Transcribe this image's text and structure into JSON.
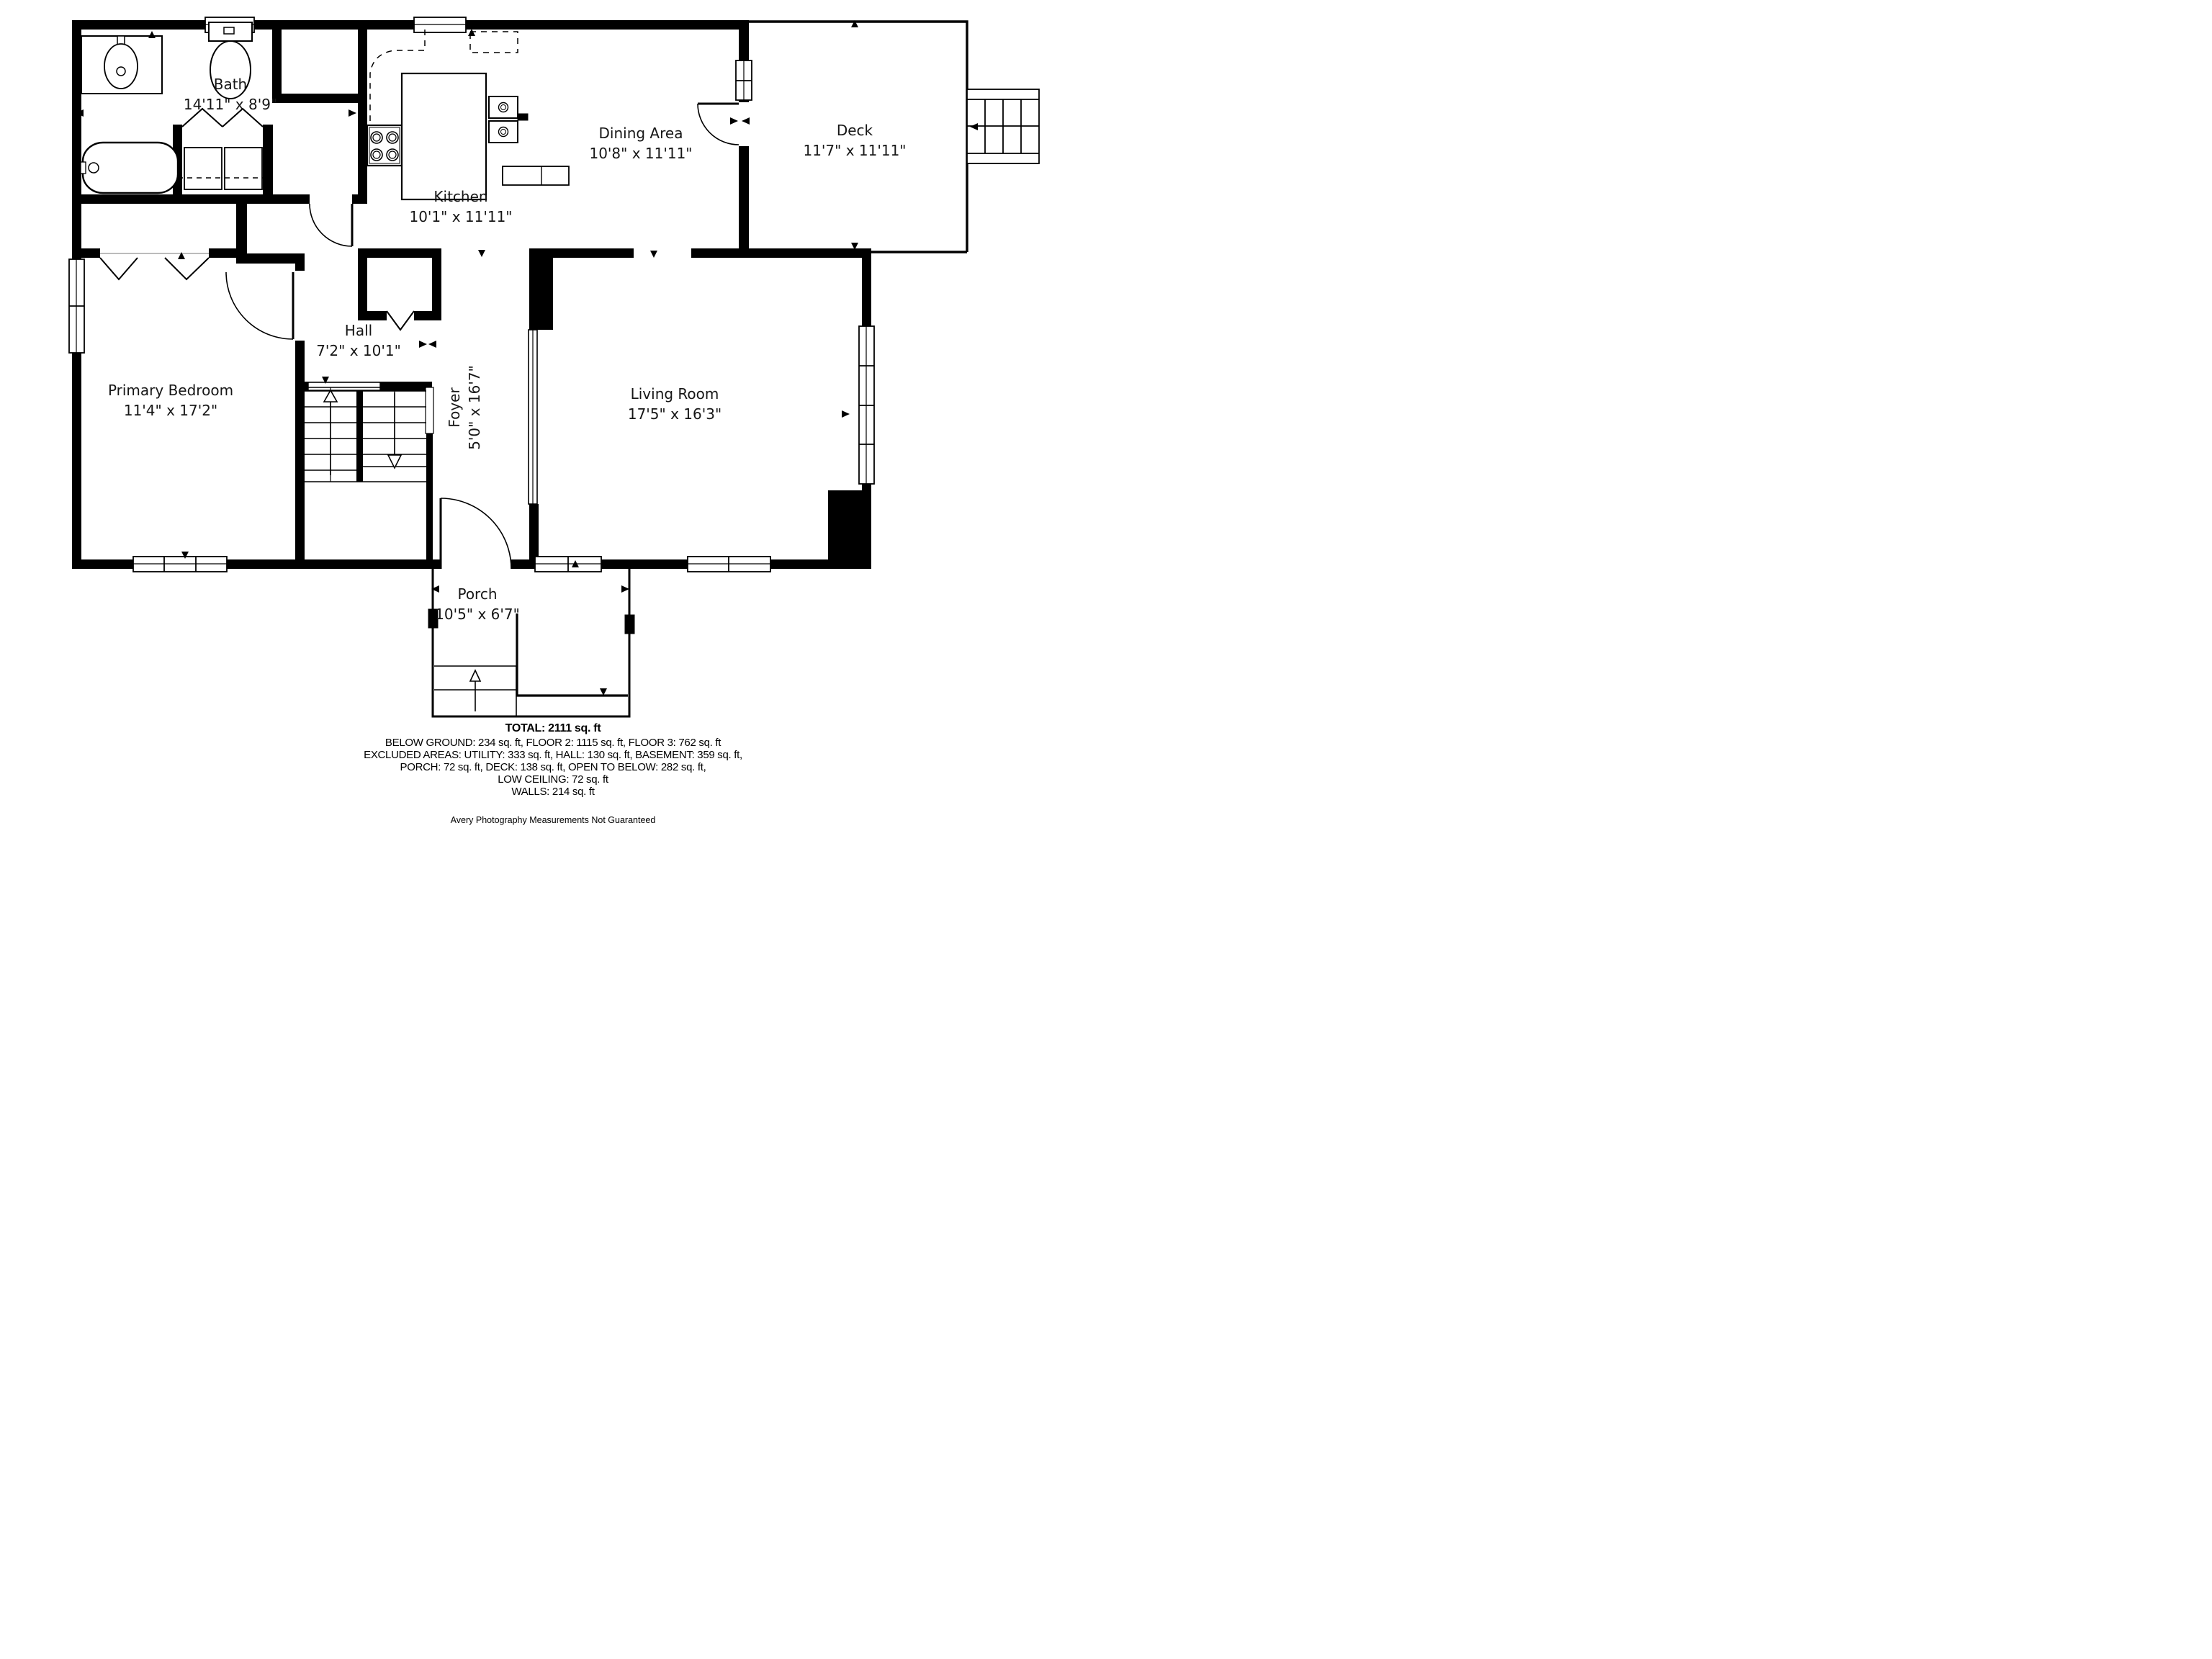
{
  "plan": {
    "rooms": {
      "bath": {
        "name": "Bath",
        "dims": "14'11\" x 8'9\""
      },
      "kitchen": {
        "name": "Kitchen",
        "dims": "10'1\" x 11'11\""
      },
      "dining": {
        "name": "Dining Area",
        "dims": "10'8\" x 11'11\""
      },
      "deck": {
        "name": "Deck",
        "dims": "11'7\" x 11'11\""
      },
      "hall": {
        "name": "Hall",
        "dims": "7'2\" x 10'1\""
      },
      "foyer": {
        "name": "Foyer",
        "dims": "5'0\" x 16'7\""
      },
      "primary_bedroom": {
        "name": "Primary Bedroom",
        "dims": "11'4\" x 17'2\""
      },
      "living_room": {
        "name": "Living Room",
        "dims": "17'5\" x 16'3\""
      },
      "porch": {
        "name": "Porch",
        "dims": "10'5\" x 6'7\""
      }
    }
  },
  "summary": {
    "total": "TOTAL: 2111 sq. ft",
    "line1": "BELOW GROUND: 234 sq. ft, FLOOR 2: 1115 sq. ft, FLOOR 3: 762 sq. ft",
    "line2": "EXCLUDED AREAS: UTILITY: 333 sq. ft, HALL: 130 sq. ft, BASEMENT: 359 sq. ft,",
    "line3": "PORCH: 72 sq. ft, DECK: 138 sq. ft, OPEN TO BELOW: 282 sq. ft,",
    "line4": "LOW CEILING: 72 sq. ft",
    "line5": "WALLS: 214 sq. ft"
  },
  "footer": "Avery Photography Measurements Not Guaranteed",
  "colors": {
    "walls": "#000000",
    "background": "#ffffff"
  }
}
